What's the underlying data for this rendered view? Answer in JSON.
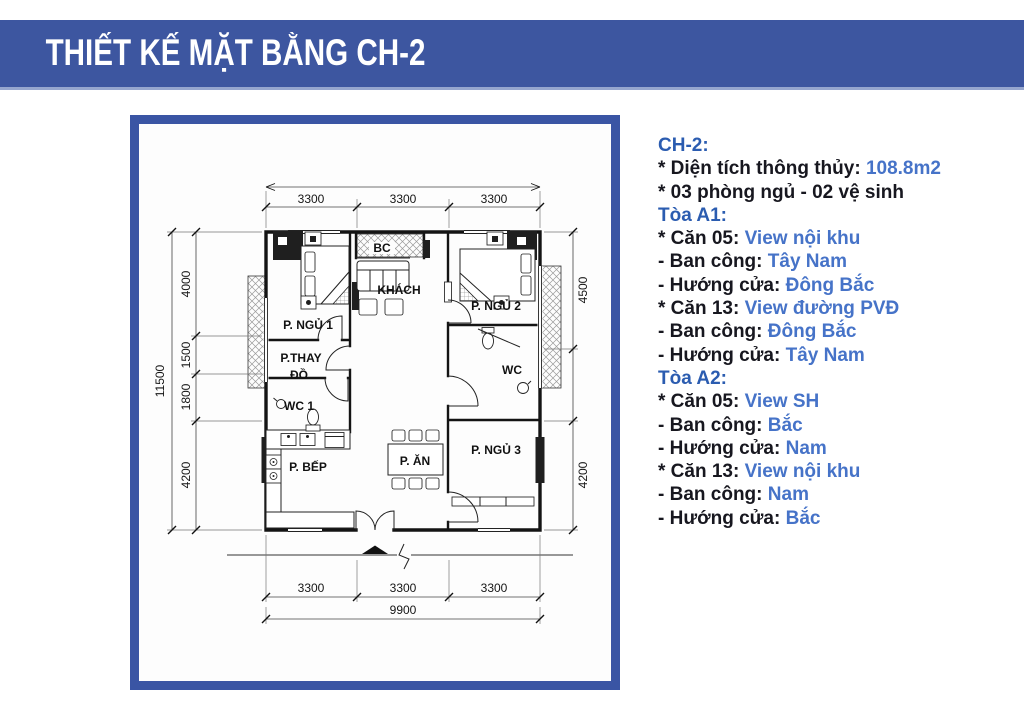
{
  "header": {
    "title": "THIẾT KẾ MẶT BẰNG CH-2"
  },
  "plan": {
    "rooms": {
      "bedroom1": "P. NGỦ 1",
      "balcony": "BC",
      "living": "KHÁCH",
      "bedroom2": "P. NGỦ 2",
      "dressing_line1": "P.THAY",
      "dressing_line2": "ĐỒ",
      "wc1": "WC 1",
      "wc2": "WC",
      "kitchen": "P. BẾP",
      "dining": "P. ĂN",
      "bedroom3": "P. NGỦ 3"
    },
    "dims": {
      "top": [
        "3300",
        "3300",
        "3300"
      ],
      "bottom": [
        "3300",
        "3300",
        "3300"
      ],
      "bottom_total": "9900",
      "left_total": "11500",
      "left": [
        "4000",
        "1500",
        "1800",
        "4200"
      ],
      "right": [
        "4500",
        "4200"
      ]
    }
  },
  "details": {
    "lines": [
      {
        "label": "CH-2:",
        "value": ""
      },
      {
        "label": "* Diện tích thông thủy: ",
        "value": "108.8m2"
      },
      {
        "label": "* 03 phòng ngủ - 02 vệ sinh",
        "value": ""
      },
      {
        "label": "Tòa A1:",
        "value": ""
      },
      {
        "label": "* Căn 05: ",
        "value": "View nội khu"
      },
      {
        "label": "- Ban công: ",
        "value": "Tây Nam"
      },
      {
        "label": "- Hướng cửa: ",
        "value": "Đông Bắc"
      },
      {
        "label": "* Căn 13: ",
        "value": "View đường PVĐ"
      },
      {
        "label": "- Ban công: ",
        "value": "Đông Bắc"
      },
      {
        "label": "- Hướng cửa: ",
        "value": "Tây Nam"
      },
      {
        "label": "Tòa A2:",
        "value": ""
      },
      {
        "label": "* Căn 05: ",
        "value": "View SH"
      },
      {
        "label": "- Ban công: ",
        "value": "Bắc"
      },
      {
        "label": "- Hướng cửa: ",
        "value": "Nam"
      },
      {
        "label": "* Căn 13: ",
        "value": "View nội khu"
      },
      {
        "label": "- Ban công: ",
        "value": "Nam"
      },
      {
        "label": "- Hướng cửa: ",
        "value": "Bắc"
      }
    ]
  },
  "colors": {
    "banner": "#3d56a0",
    "frame": "#3a55a4",
    "heading_blue": "#2b5cb0",
    "value_blue": "#4673c8",
    "text_dark": "#17171f"
  }
}
